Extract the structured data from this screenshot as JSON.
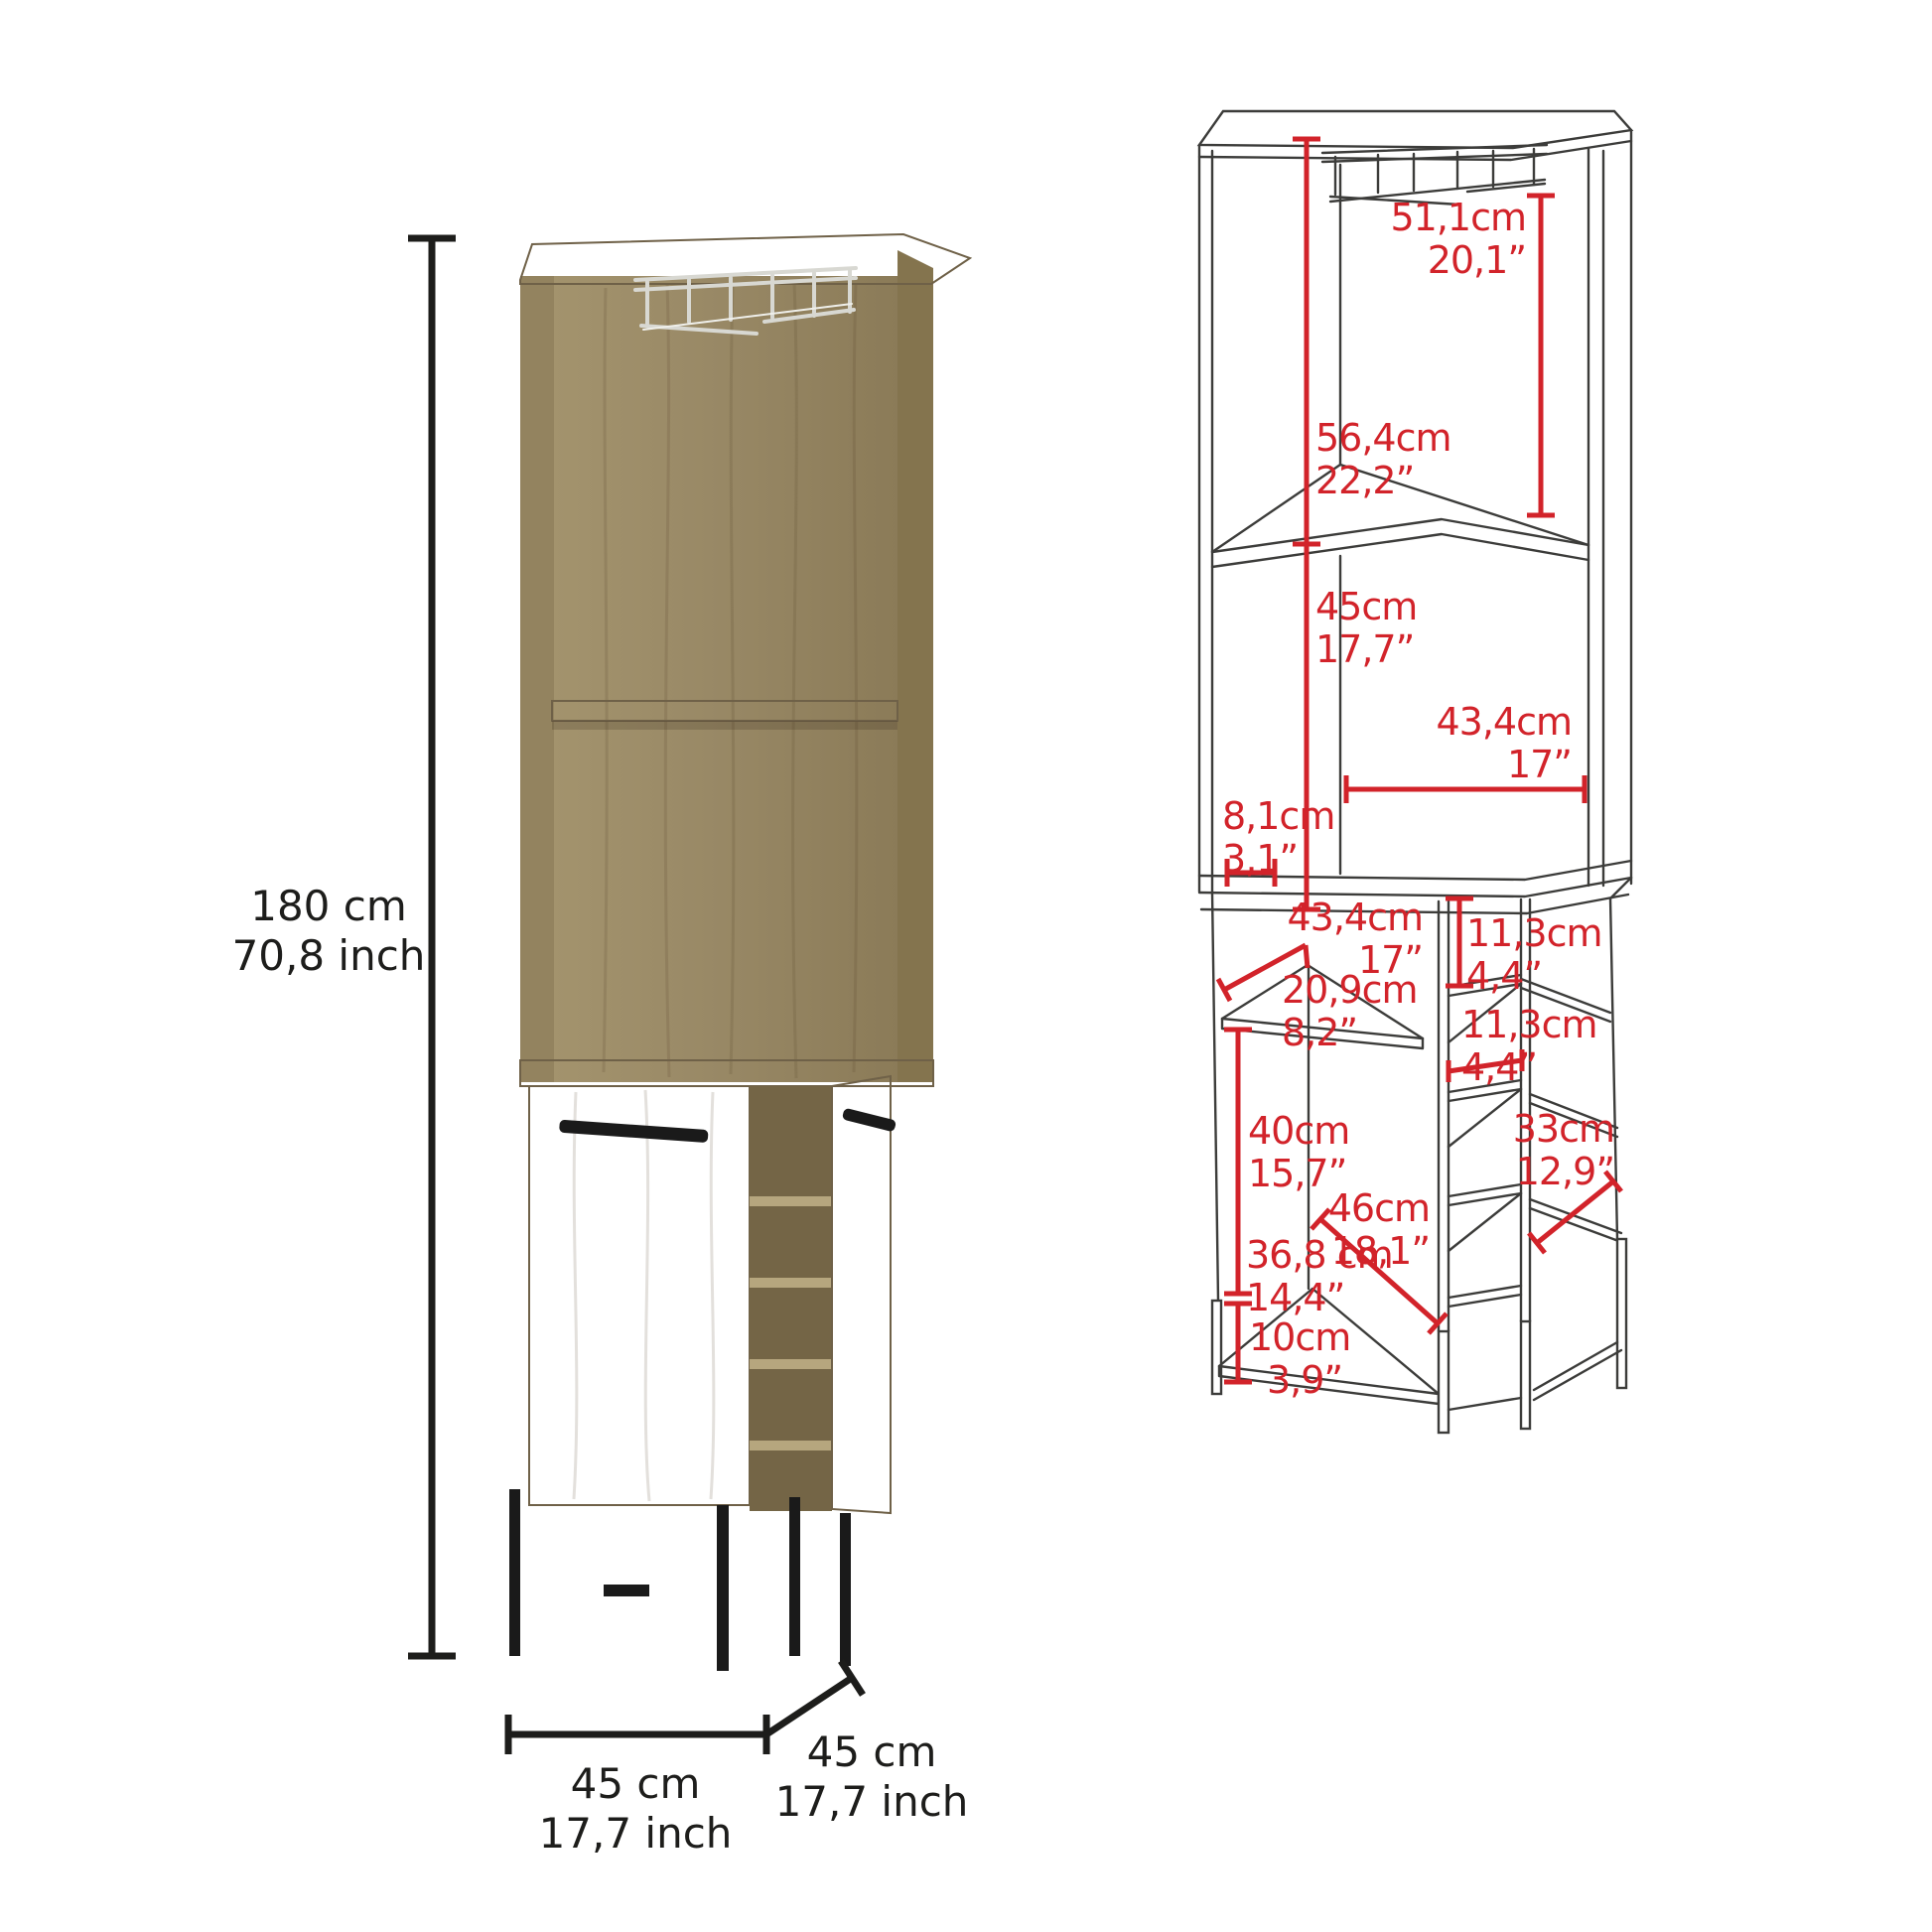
{
  "left_figure": {
    "height": {
      "cm": "180 cm",
      "inch": "70,8 inch"
    },
    "width": {
      "cm": "45 cm",
      "inch": "17,7 inch"
    },
    "depth": {
      "cm": "45 cm",
      "inch": "17,7 inch"
    }
  },
  "right_figure": {
    "dimensions": {
      "glass_rack_height": {
        "cm": "51,1cm",
        "inch": "20,1”"
      },
      "upper_opening_height": {
        "cm": "56,4cm",
        "inch": "22,2”"
      },
      "middle_opening_height": {
        "cm": "45cm",
        "inch": "17,7”"
      },
      "upper_width": {
        "cm": "43,4cm",
        "inch": "17”"
      },
      "side_panel_depth": {
        "cm": "8,1cm",
        "inch": "3,1”"
      },
      "lower_width": {
        "cm": "43,4cm",
        "inch": "17”"
      },
      "cubby_height_top": {
        "cm": "11,3cm",
        "inch": "4,4”"
      },
      "corner_shelf_side": {
        "cm": "20,9cm",
        "inch": "8,2”"
      },
      "cubby_height_mid": {
        "cm": "11,3cm",
        "inch": "4,4”"
      },
      "lower_opening_height": {
        "cm": "40cm",
        "inch": "15,7”"
      },
      "side_shelf_width": {
        "cm": "33cm",
        "inch": "12,9”"
      },
      "lower_diagonal": {
        "cm": "46cm",
        "inch": "18,1”"
      },
      "base_shelf_width": {
        "cm": "36,8 cm",
        "inch": "14,4”"
      },
      "leg_height": {
        "cm": "10cm",
        "inch": "3,9”"
      }
    }
  },
  "colors": {
    "dimension_red": "#d2232a",
    "line_black": "#1d1d1b",
    "drawing_line": "#3c3c3a",
    "metal_black": "#1a1a1a",
    "chrome": "#d8d8d2",
    "wood_light": "#b6a67e",
    "wood_mid": "#9c8c66",
    "wood_dark": "#84744e"
  }
}
